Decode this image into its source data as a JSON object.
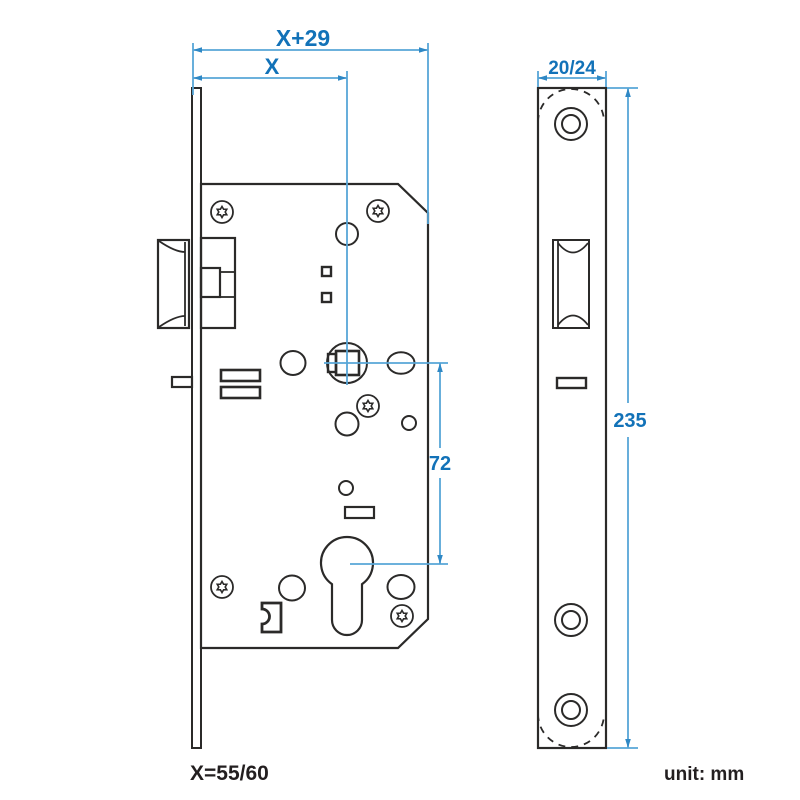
{
  "diagram": {
    "type": "mortise-lock-dimension-drawing",
    "unit_note": "unit: mm",
    "backset_note": "X=55/60",
    "dimensions": {
      "total_depth": "X+29",
      "backset": "X",
      "faceplate_width": "20/24",
      "faceplate_length": "235",
      "center_distance": "72"
    },
    "colors": {
      "outline": "#2b2a29",
      "dimension_line": "#57a6d7",
      "dimension_text": "#1272b8",
      "note_text": "#231f20",
      "background": "#ffffff"
    }
  }
}
